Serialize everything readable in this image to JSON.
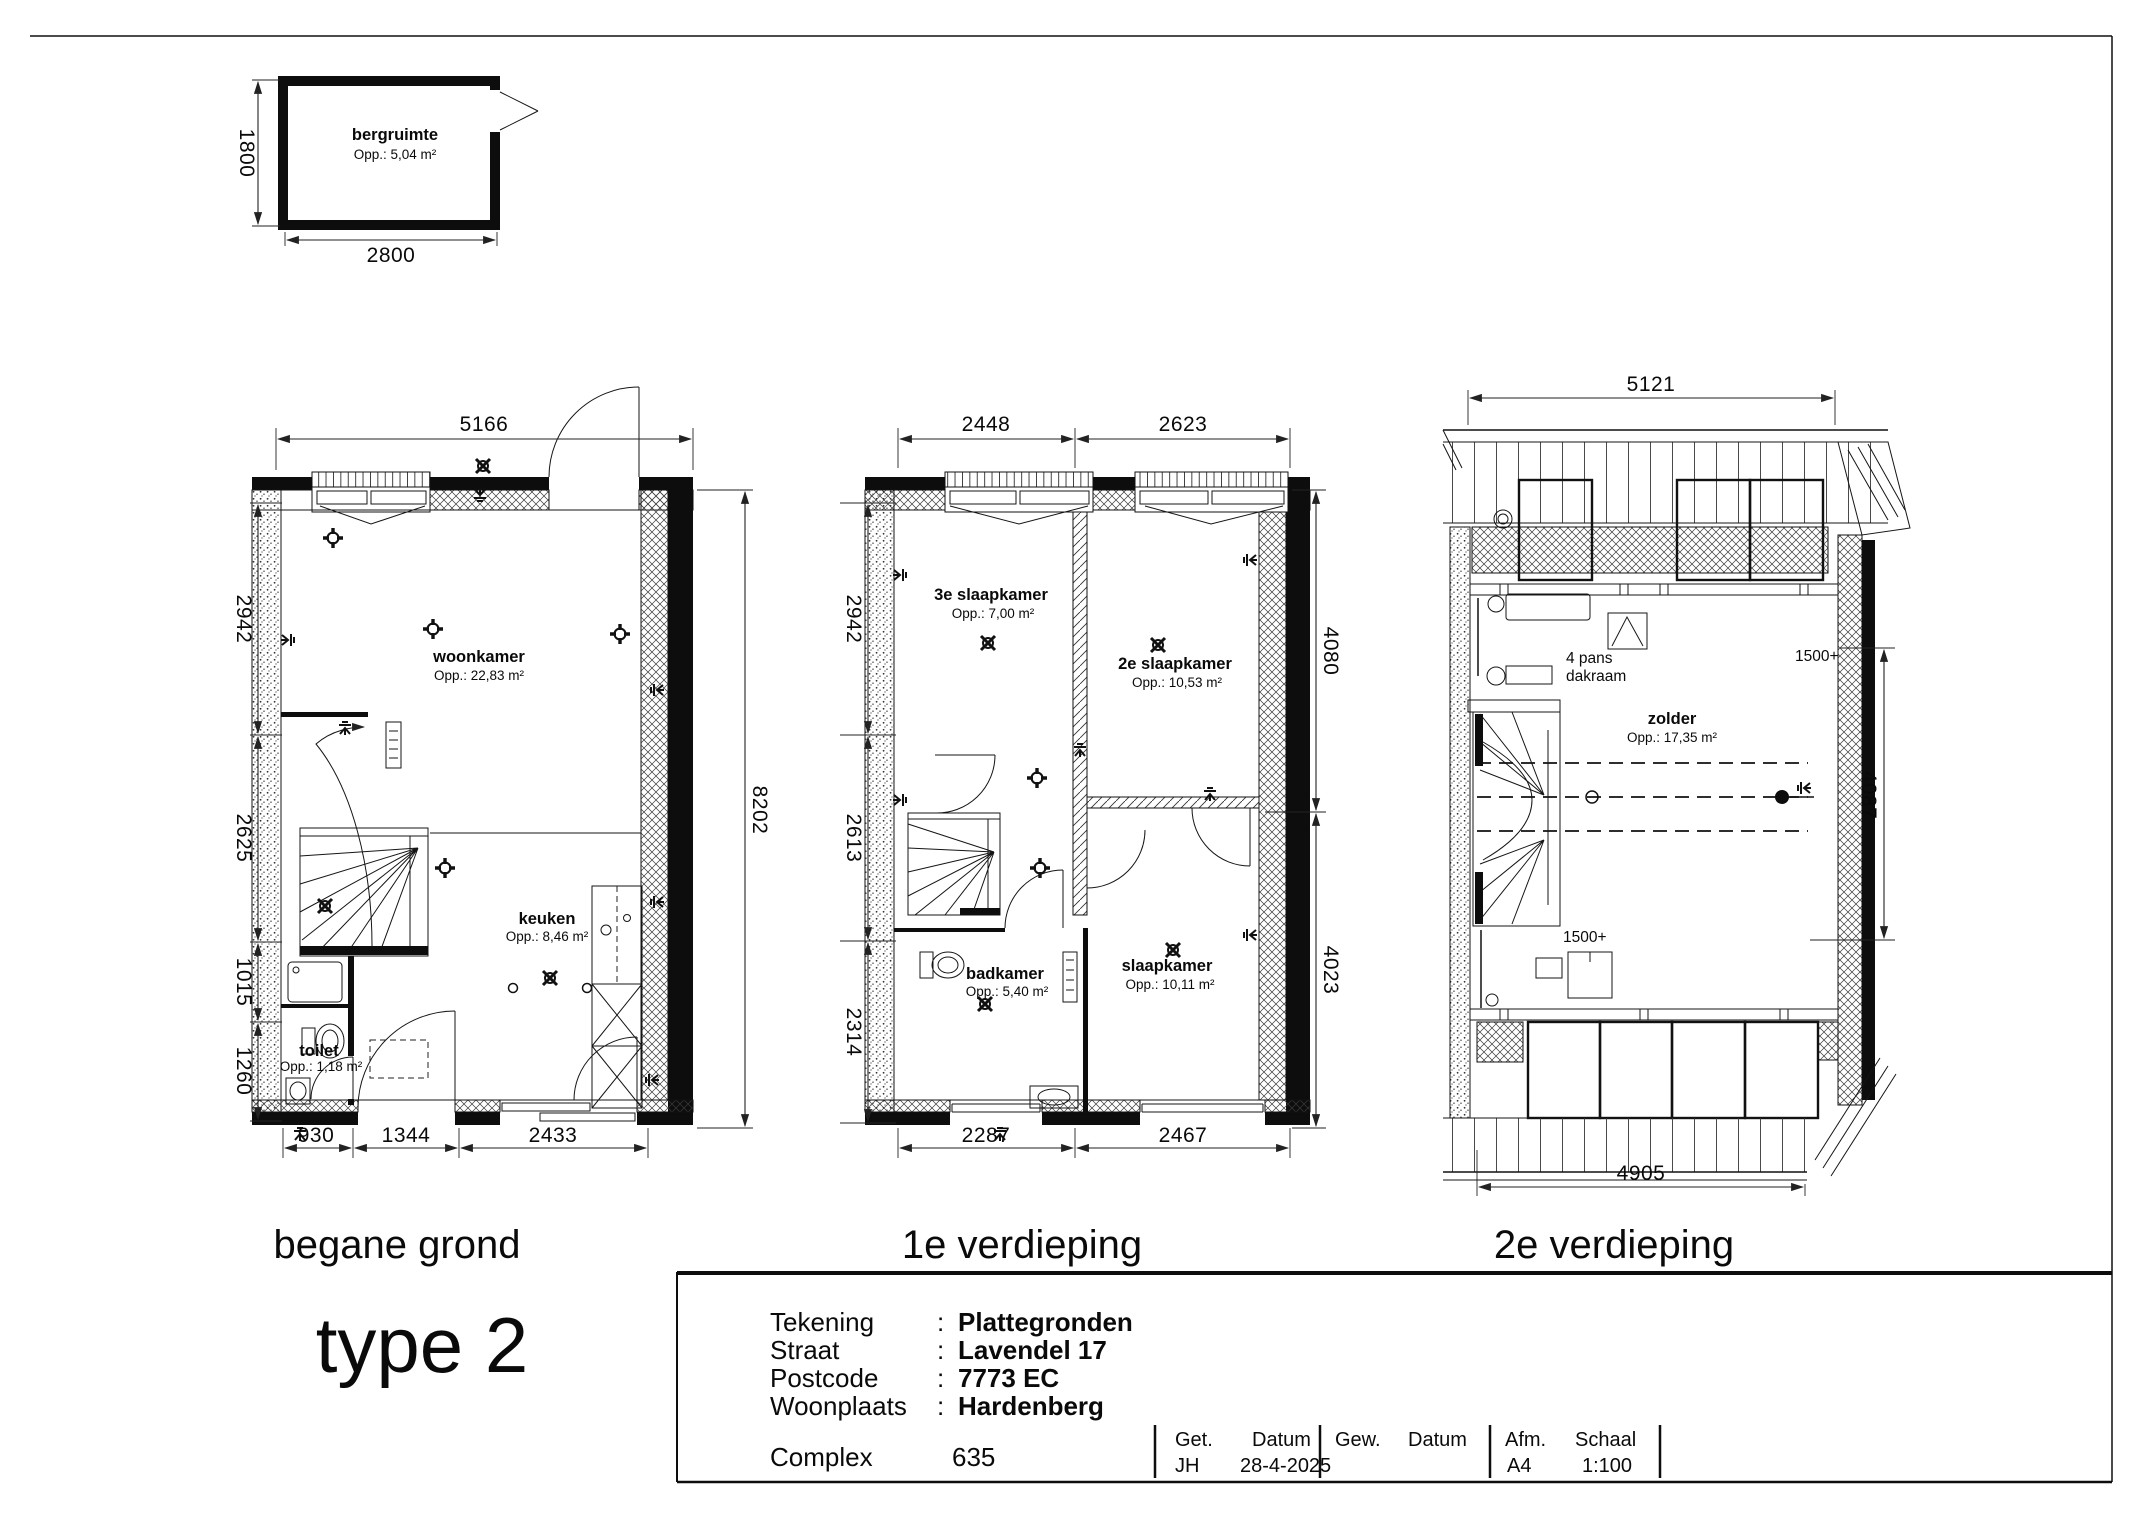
{
  "storage_plan": {
    "name": "bergruimte",
    "area": "Opp.:  5,04 m²",
    "dim_width": "2800",
    "dim_height": "1800"
  },
  "ground_floor": {
    "title": "begane grond",
    "rooms": {
      "woonkamer": {
        "name": "woonkamer",
        "area": "Opp.: 22,83 m²"
      },
      "keuken": {
        "name": "keuken",
        "area": "Opp.: 8,46 m²"
      },
      "toilet": {
        "name": "toilet",
        "area": "Opp.: 1,18 m²"
      }
    },
    "dims": {
      "top": "5166",
      "right": "8202",
      "left": [
        "2942",
        "2625",
        "1015",
        "1260"
      ],
      "bottom": [
        "930",
        "1344",
        "2433"
      ]
    }
  },
  "first_floor": {
    "title": "1e verdieping",
    "rooms": {
      "slaapkamer3": {
        "name": "3e slaapkamer",
        "area": "Opp.: 7,00 m²"
      },
      "slaapkamer2": {
        "name": "2e slaapkamer",
        "area": "Opp.: 10,53 m²"
      },
      "badkamer": {
        "name": "badkamer",
        "area": "Opp.: 5,40 m²"
      },
      "slaapkamer": {
        "name": "slaapkamer",
        "area": "Opp.: 10,11 m²"
      }
    },
    "dims": {
      "top": [
        "2448",
        "2623"
      ],
      "left": [
        "2942",
        "2613",
        "2314"
      ],
      "right": [
        "4080",
        "4023"
      ],
      "bottom": [
        "2287",
        "2467"
      ]
    }
  },
  "second_floor": {
    "title": "2e verdieping",
    "rooms": {
      "zolder": {
        "name": "zolder",
        "area": "Opp.: 17,35 m²"
      }
    },
    "annotations": {
      "dakraam_line1": "4 pans",
      "dakraam_line2": "dakraam",
      "headroom_bottom": "1500+",
      "headroom_right": "1500+"
    },
    "dims": {
      "top": "5121",
      "right": "4087",
      "bottom": "4905"
    }
  },
  "type_label": "type 2",
  "title_block": {
    "rows": [
      {
        "label": "Tekening",
        "sep": ":",
        "value": "Plattegronden"
      },
      {
        "label": "Straat",
        "sep": ":",
        "value": "Lavendel 17"
      },
      {
        "label": "Postcode",
        "sep": ":",
        "value": "7773 EC"
      },
      {
        "label": "Woonplaats",
        "sep": ":",
        "value": "Hardenberg"
      }
    ],
    "complex_label": "Complex",
    "complex_value": "635",
    "sign_off": {
      "get_label": "Get.",
      "get_value": "JH",
      "datum1_label": "Datum",
      "datum1_value": "28-4-2025",
      "gew_label": "Gew.",
      "datum2_label": "Datum",
      "afm_label": "Afm.",
      "afm_value": "A4",
      "schaal_label": "Schaal",
      "schaal_value": "1:100"
    }
  }
}
